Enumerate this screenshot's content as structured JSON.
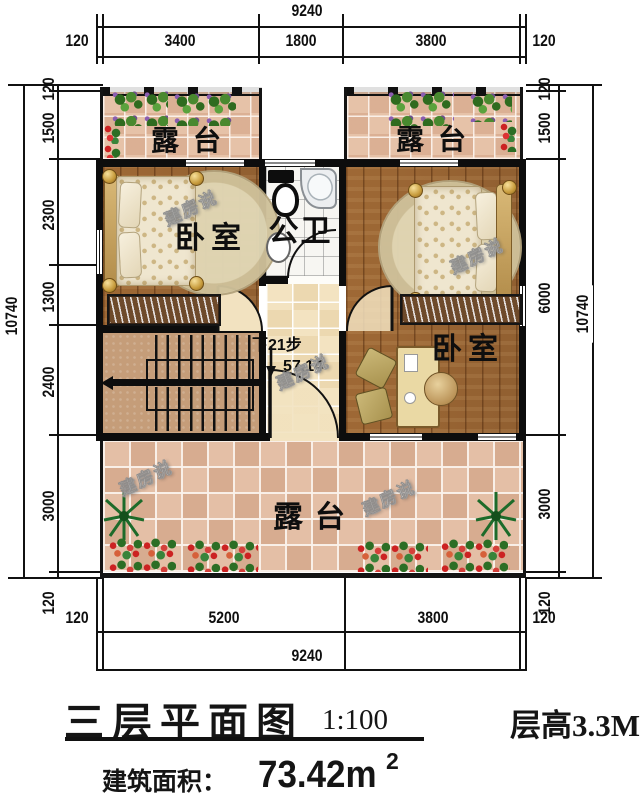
{
  "title_block": {
    "plan_title": "三层平面图",
    "plan_scale": "1:100",
    "floor_height": "层高3.3M",
    "area_label": "建筑面积：",
    "area_value": "73.42m",
    "area_exponent": "2"
  },
  "dimensions": {
    "top": {
      "total": "9240",
      "segments": [
        "120",
        "3400",
        "1800",
        "3800",
        "120"
      ]
    },
    "bottom": {
      "total": "9240",
      "segments": [
        "120",
        "5200",
        "3800",
        "120"
      ]
    },
    "left": {
      "total": "10740",
      "segments": [
        "120",
        "1500",
        "2300",
        "1300",
        "2400",
        "3000",
        "120"
      ]
    },
    "right": {
      "total": "10740",
      "segments": [
        "120",
        "1500",
        "6000",
        "3000",
        "120"
      ]
    }
  },
  "rooms": {
    "terrace_top_left": "露台",
    "terrace_top_right": "露台",
    "bedroom_left": "卧室",
    "bedroom_right": "卧室",
    "bathroom": "公卫",
    "terrace_bottom": "露台"
  },
  "stairs": {
    "note": "下21步",
    "level": "57.14"
  },
  "watermark": {
    "text": "建房说"
  },
  "colors": {
    "wall": "#0d0d0d",
    "wood_floor": "#a8713c",
    "terrace_tile": "#e2bba0",
    "hall_tile": "#f3e3c1",
    "bath_tile": "#f7f6f2",
    "stair_floor": "#c59d79"
  }
}
